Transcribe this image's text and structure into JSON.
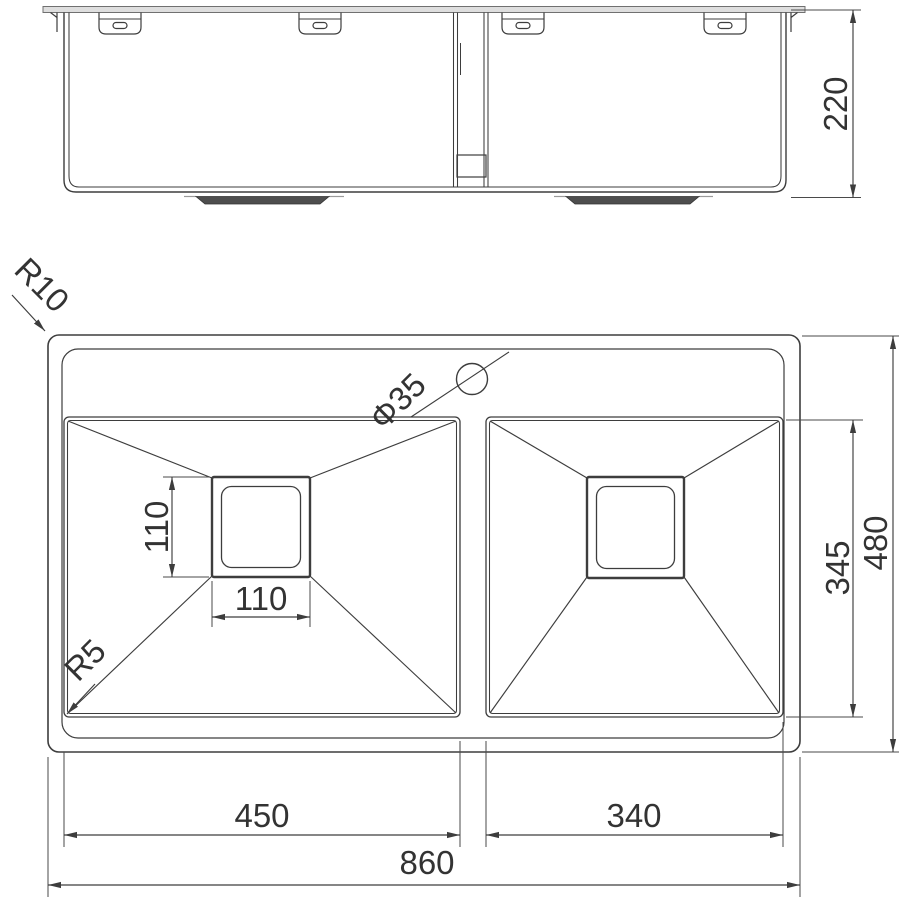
{
  "colors": {
    "background": "#ffffff",
    "line": "#3d3d3d",
    "text": "#333333",
    "countertop_fill": "#dedede",
    "drain_boss_fill": "#4e4e4e"
  },
  "views": {
    "front": {
      "dim_depth": "220"
    },
    "plan": {
      "dim_overall_width": "860",
      "dim_overall_depth": "480",
      "dim_left_bowl_width": "450",
      "dim_right_bowl_width": "340",
      "dim_bowl_depth": "345",
      "dim_drain_width": "110",
      "dim_drain_height": "110",
      "label_outer_radius": "R10",
      "label_bowl_radius": "R5",
      "label_tap_hole": "Φ35"
    }
  }
}
